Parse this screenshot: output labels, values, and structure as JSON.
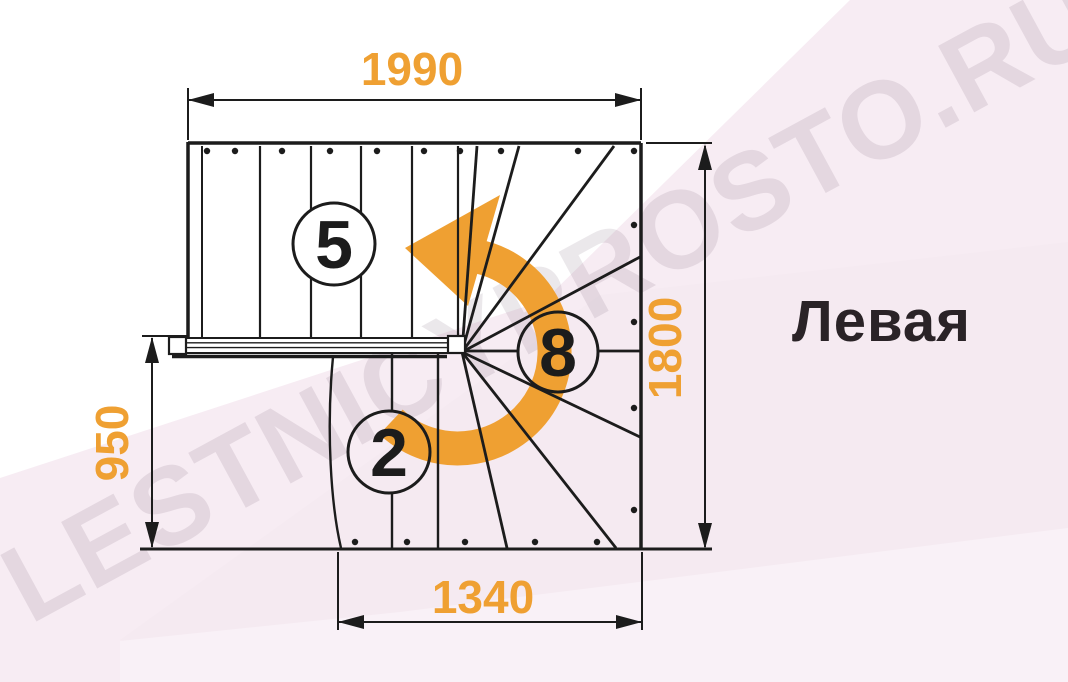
{
  "diagram": {
    "title": "Левая",
    "watermark": "LESTNICYPROSTO.RU",
    "dimensions_mm": {
      "top_width": "1990",
      "right_height": "1800",
      "left_height": "950",
      "bottom_width": "1340"
    },
    "step_counts": {
      "upper_flight": "5",
      "winders": "8",
      "lower_flight": "2"
    },
    "colors": {
      "accent_orange": "#EFA032",
      "line_black": "#1C1C1C",
      "background_pink": "#F7ECF3",
      "title_text": "#2A2327"
    },
    "turn_direction": "counterclockwise-left"
  }
}
